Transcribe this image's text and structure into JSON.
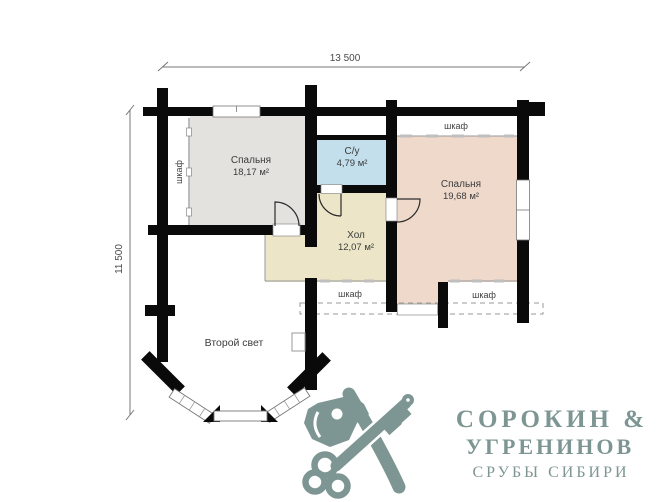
{
  "dimensions": {
    "width_label": "13 500",
    "height_label": "11 500"
  },
  "rooms": {
    "bedroom1": {
      "name": "Спальня",
      "area": "18,17 м²",
      "color": "#e3e2de"
    },
    "bathroom": {
      "name": "С/у",
      "area": "4,79 м²",
      "color": "#c4dfec"
    },
    "bedroom2": {
      "name": "Спальня",
      "area": "19,68 м²",
      "color": "#eed9cb"
    },
    "hall": {
      "name": "Хол",
      "area": "12,07 м²",
      "color": "#ece5c7"
    }
  },
  "labels": {
    "second_light": "Второй свет",
    "closet": "шкаф"
  },
  "logo": {
    "line1": "СОРОКИН &",
    "line2": "УГРЕНИНОВ",
    "line3": "СРУБЫ СИБИРИ",
    "color": "#7d9693",
    "icon": "axe-and-key-icon"
  },
  "colors": {
    "wall": "#0a0a0a",
    "thin_line": "#8a8a8a",
    "label_text": "#3b3b3b"
  }
}
